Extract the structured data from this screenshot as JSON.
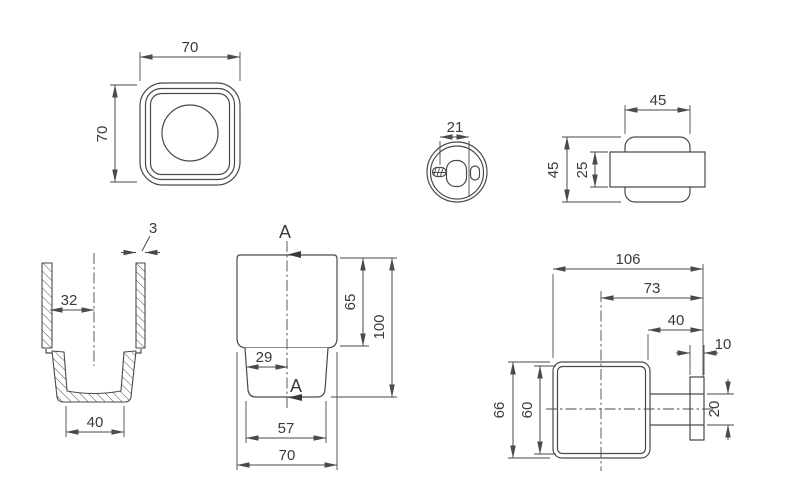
{
  "drawing": {
    "type": "technical-dimension-drawing",
    "subject": "square tumbler cup and wall-mounted holder bracket",
    "colors": {
      "background": "#ffffff",
      "line": "#4a4a4a",
      "text": "#3a3a3a"
    },
    "views": {
      "cup_top": {
        "dim_width": "70",
        "dim_height": "70"
      },
      "cup_section": {
        "dim_wall_thickness": "3",
        "dim_center_to_wall": "32",
        "dim_bottom_width": "40"
      },
      "cup_front": {
        "section_marker_top": "A",
        "section_marker_bottom": "A",
        "dim_body_height": "65",
        "dim_total_height": "100",
        "dim_center_offset": "29",
        "dim_base_width": "57",
        "dim_top_width": "70"
      },
      "holder_bottom": {
        "dim_slot_width": "21"
      },
      "holder_side": {
        "dim_plate_width": "45",
        "dim_plate_height": "45",
        "dim_arm_height": "25"
      },
      "assembly_top": {
        "dim_total_depth": "106",
        "dim_center_to_wall": "73",
        "dim_face_to_wall": "40",
        "dim_plate_thickness": "10",
        "dim_outer_width": "66",
        "dim_inner_width": "60",
        "dim_arm_width": "20"
      }
    }
  }
}
